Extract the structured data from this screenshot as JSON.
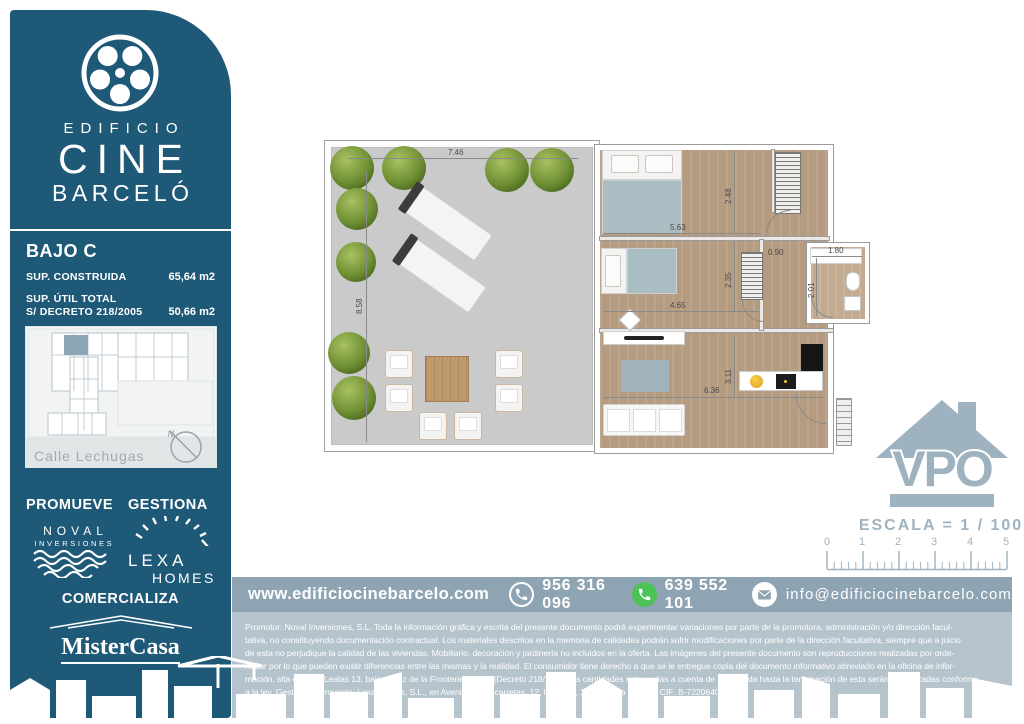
{
  "brand": {
    "line1": "EDIFICIO",
    "line2": "CINE",
    "line3": "BARCELÓ",
    "logo_icon": "film-reel-icon"
  },
  "unit": {
    "title": "BAJO C",
    "rows": [
      {
        "label": "SUP. CONSTRUIDA",
        "label2": "",
        "value": "65,64 m2"
      },
      {
        "label": "SUP. ÚTIL TOTAL",
        "label2": "S/ DECRETO 218/2005",
        "value": "50,66 m2"
      }
    ]
  },
  "map": {
    "street": "Calle Lechugas",
    "compass": "N"
  },
  "roles": {
    "promueve": "PROMUEVE",
    "gestiona": "GESTIONA",
    "comercializa": "COMERCIALIZA"
  },
  "logos": {
    "noval_line1": "NOVAL",
    "noval_line2": "INVERSIONES",
    "lexa_line1": "LEXA",
    "lexa_line2": "HOMES",
    "mistercasa": "MisterCasa",
    "vpo": "VPO"
  },
  "plan": {
    "dims": {
      "terrace_w": "7.46",
      "terrace_h": "8.58",
      "bed1_w": "5.63",
      "bed1_h": "2.48",
      "bed2_w": "4.65",
      "bed2_h": "2.35",
      "hall_w": "0.90",
      "bath_w": "1.80",
      "bath_h": "2.01",
      "living_w": "6.36",
      "living_h": "3.11"
    }
  },
  "scale": {
    "label": "ESCALA = 1 / 100",
    "ticks": [
      "0",
      "1",
      "2",
      "3",
      "4",
      "5"
    ]
  },
  "contact": {
    "web": "www.edificiocinebarcelo.com",
    "phone": "956 316 096",
    "whatsapp": "639 552 101",
    "email": "info@edificiocinebarcelo.com"
  },
  "legal": {
    "lines": [
      "Promotor: Noval Inversiones, S.L. Toda la información gráfica y escrita del presente documento podrá experimentar variaciones por parte de la promotora, administración y/o dirección facul-",
      "tativa, no constituyendo documentación contractual. Los materiales descritos en la memoria de calidades podrán sufrir modificaciones por parte de la dirección facultativa, siempre que a juicio",
      "de esta no perjudique la calidad de las viviendas. Mobiliario, decoración y jardinería no incluidos en la oferta. Las imágenes del presente documento son reproducciones realizadas por orde-",
      "nador por lo que pueden existir diferencias entre las mismas y la realidad. El consumidor tiene derecho a que se le entregue copia del documento informativo abreviado en la oficina de infor-",
      "mación, sita en calle Lealas 13, bajo, Jerez de la Frontera (Cádiz) (Decreto 218/200). Las cantidades entregadas a cuenta de la vivienda hasta la terminación de esta serán garantizadas conforme",
      "a la ley. Gestión de Proyecto: Lexa Homes, S.L., en Avenida Valdecarretas, 12, local 1.1, 11520, Rota (Cádiz). CIF: B-72206402."
    ]
  },
  "colors": {
    "sidebar_blue": "#1f5978",
    "contact_bar": "#8fa4b3",
    "legal_bg": "#b5c3cd",
    "vpo_gray": "#9eb2c0",
    "whatsapp_green": "#4dc257",
    "minimap_highlight": "#8da6b5",
    "terrace_floor": "#cacaca",
    "wood_floor": "#b59b80",
    "plant_green": "#6e8f33"
  }
}
